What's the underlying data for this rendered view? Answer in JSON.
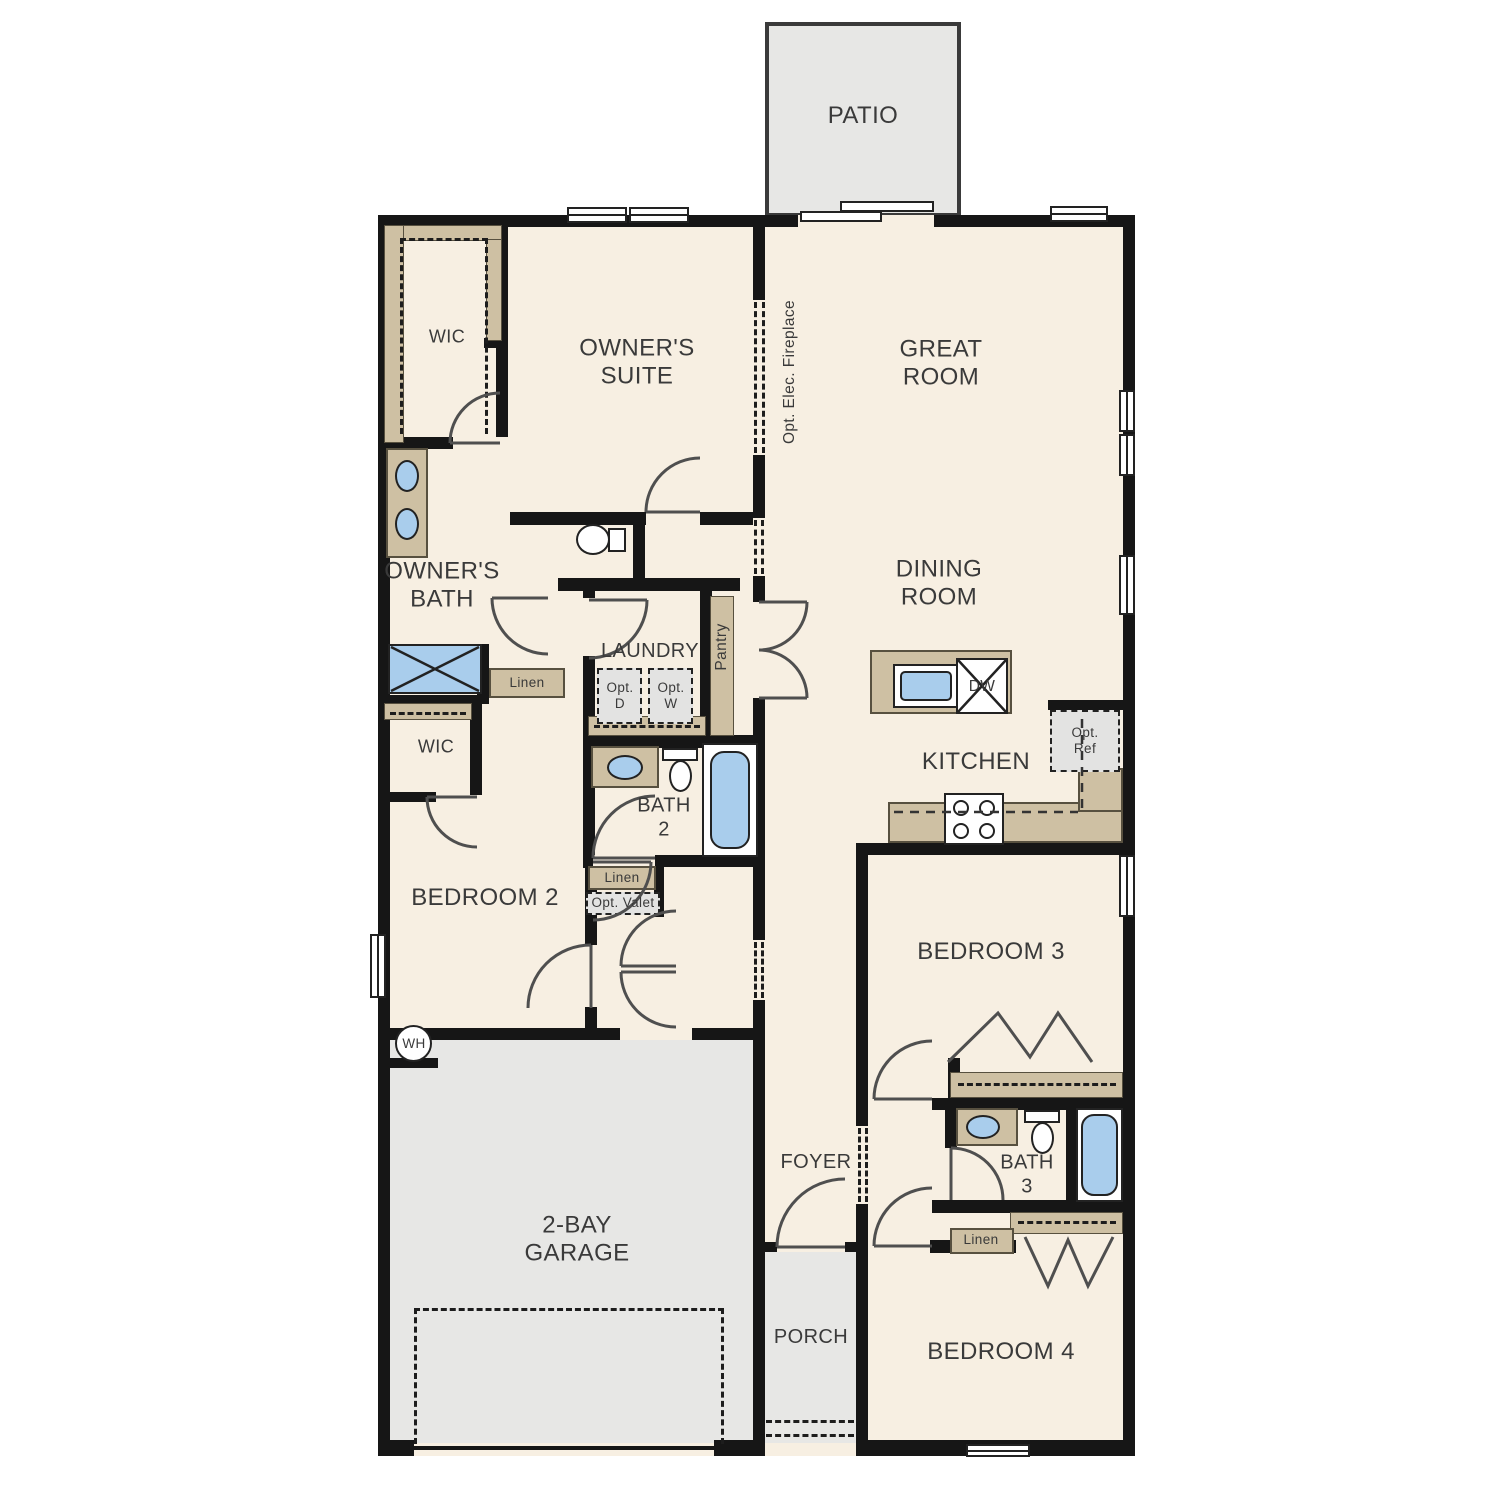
{
  "colors": {
    "floor": "#f7efe2",
    "outdoor": "#e7e7e5",
    "wall": "#161616",
    "cabinet": "#cec0a3",
    "blue": "#a9cdec",
    "optional": "#e3e3e2",
    "ink": "#3a3a3a"
  },
  "labels": {
    "patio": "PATIO",
    "owners_suite": "OWNER'S\nSUITE",
    "wic_1": "WIC",
    "great_room": "GREAT\nROOM",
    "opt_fireplace": "Opt. Elec. Fireplace",
    "owners_bath": "OWNER'S\nBATH",
    "laundry": "LAUNDRY",
    "opt_dryer": "Opt.\nD",
    "opt_washer": "Opt.\nW",
    "pantry": "Pantry",
    "dining_room": "DINING\nROOM",
    "kitchen": "KITCHEN",
    "dishwasher": "DW",
    "opt_refrigerator": "Opt.\nRef",
    "linen_owners": "Linen",
    "wic_2": "WIC",
    "bath_2": "BATH\n2",
    "bedroom_2": "BEDROOM 2",
    "linen_hall": "Linen",
    "opt_valet": "Opt. Valet",
    "garage": "2-BAY\nGARAGE",
    "water_heater": "WH",
    "foyer": "FOYER",
    "porch": "PORCH",
    "bedroom_3": "BEDROOM 3",
    "bath_3": "BATH\n3",
    "linen_bath3": "Linen",
    "bedroom_4": "BEDROOM 4"
  }
}
